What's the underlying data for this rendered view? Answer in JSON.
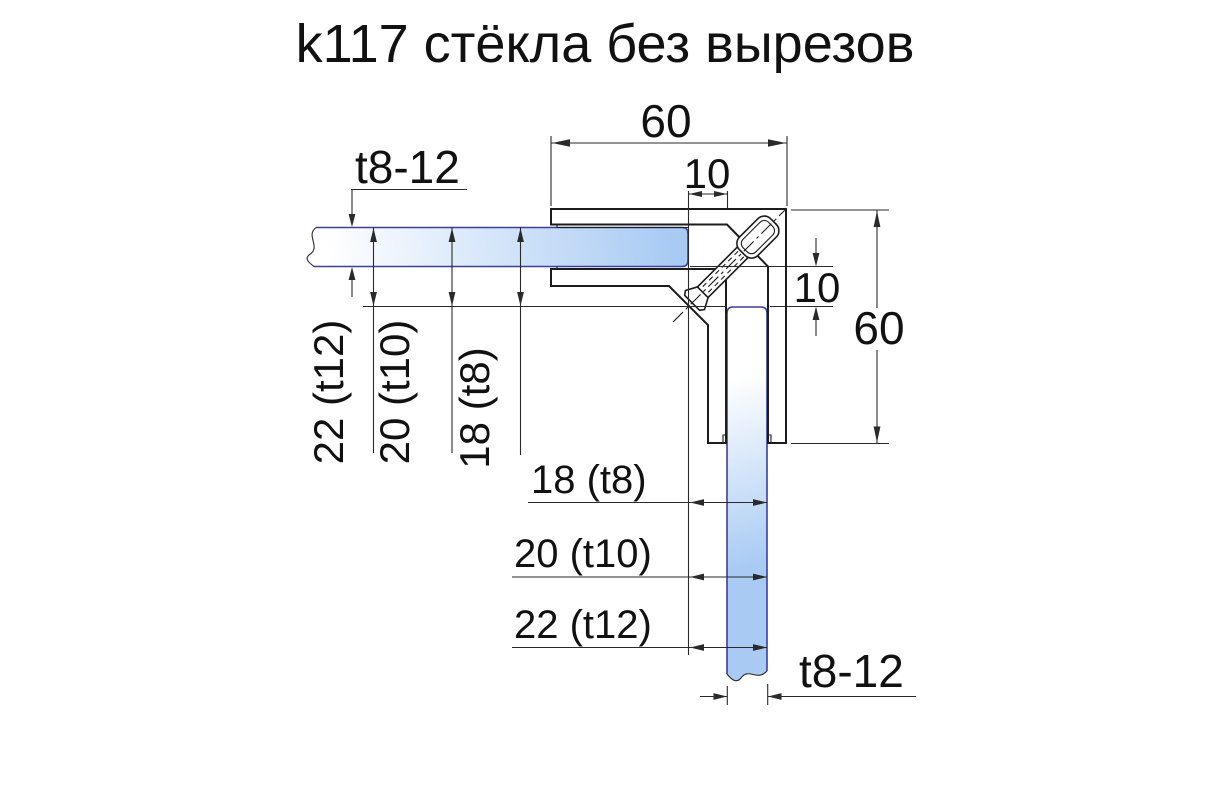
{
  "title": "k117 стёкла без вырезов",
  "dims": {
    "top_width": "60",
    "top_gap": "10",
    "thickness_top": "t8-12",
    "left_offsets": [
      "22 (t12)",
      "20 (t10)",
      "18 (t8)"
    ],
    "right_gap": "10",
    "right_height": "60",
    "bottom_offsets": [
      "18 (t8)",
      "20 (t10)",
      "22 (t12)"
    ],
    "thickness_bottom": "t8-12"
  },
  "colors": {
    "line": "#1c1c1c",
    "dim": "#2a2a2a",
    "text": "#111111",
    "glass_edge": "#3b3f9e",
    "glass_light": "#ffffff",
    "glass_blue": "#a9cbf3",
    "background": "#ffffff"
  }
}
